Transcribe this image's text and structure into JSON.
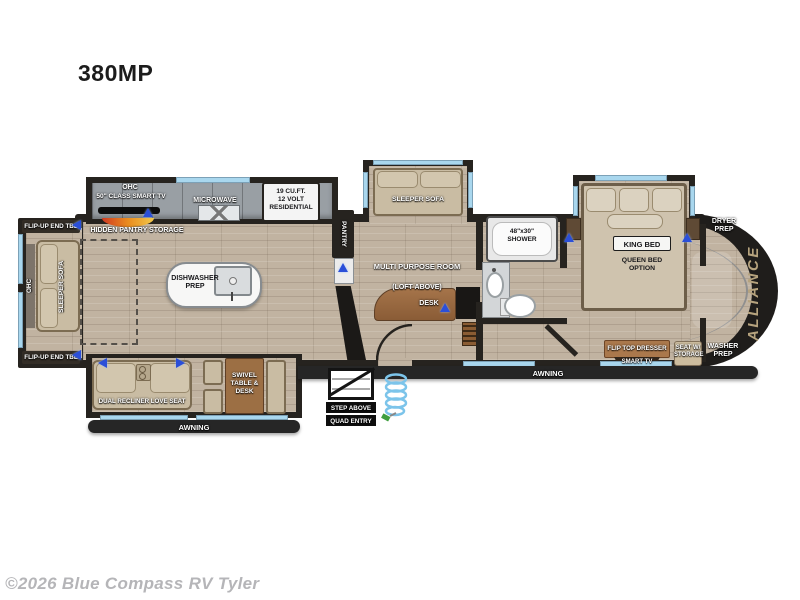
{
  "page": {
    "title": "380MP",
    "watermark": "©2026 Blue Compass RV Tyler"
  },
  "floorplan": {
    "brand": "ALLIANCE",
    "rear_slide": {
      "flip_up_end_tbl_top": "FLIP-UP END TBL",
      "flip_up_end_tbl_bottom": "FLIP-UP END TBL",
      "sleeper_sofa": "SLEEPER SOFA",
      "ohc": "OHC"
    },
    "kitchen": {
      "ohc": "OHC",
      "smart_tv": "50\" CLASS SMART TV",
      "hidden_pantry": "HIDDEN PANTRY STORAGE",
      "microwave": "MICROWAVE",
      "fridge_line1": "19 CU.FT.",
      "fridge_line2": "12 VOLT",
      "fridge_line3": "RESIDENTIAL",
      "pantry": "PANTRY",
      "island_line1": "DISHWASHER",
      "island_line2": "PREP"
    },
    "mpr": {
      "sleeper_sofa": "SLEEPER SOFA",
      "room": "MULTI PURPOSE ROOM",
      "loft": "(LOFT ABOVE)",
      "desk": "DESK"
    },
    "bath": {
      "shower_line1": "48\"x30\"",
      "shower_line2": "SHOWER"
    },
    "bedroom": {
      "king_bed": "KING BED",
      "queen_line1": "QUEEN BED",
      "queen_line2": "OPTION",
      "dresser": "FLIP TOP DRESSER",
      "smart_tv": "SMART TV",
      "seat_line1": "SEAT W/",
      "seat_line2": "STORAGE"
    },
    "front": {
      "dryer_line1": "DRYER",
      "dryer_line2": "PREP",
      "washer_line1": "WASHER",
      "washer_line2": "PREP"
    },
    "living_slide": {
      "loveseat": "DUAL RECLINER LOVE SEAT",
      "table_line1": "SWIVEL",
      "table_line2": "TABLE &",
      "table_line3": "DESK",
      "awning": "AWNING"
    },
    "exterior": {
      "awning_right": "AWNING",
      "step_above": "STEP ABOVE",
      "quad_entry": "QUAD ENTRY"
    },
    "colors": {
      "window_blue": "#a9d7ee",
      "wall_dark": "#26231f",
      "brand_gold": "#b6a37e",
      "floor_tan": "#c1b3a1",
      "accent_blue": "#2b4fd8"
    }
  }
}
